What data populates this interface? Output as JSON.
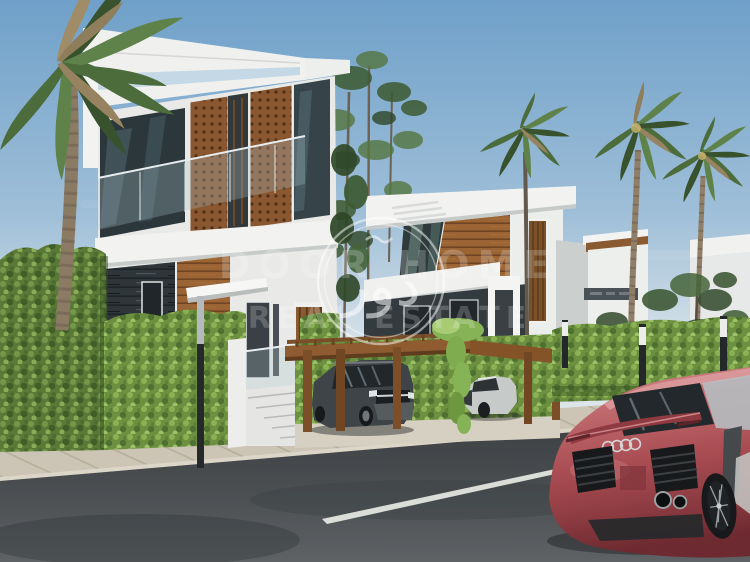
{
  "image": {
    "type": "3d-architectural-rendering",
    "subject": "Street view of modern white two-storey villas with wood mashrabiya panels, carport pergola with two SUVs, palm trees, hedges and a red Audi R8 coupe on the road",
    "width": 750,
    "height": 562
  },
  "watermark": {
    "logo_arabic": "دور",
    "line1": "DOOR HOME",
    "line2": "REAL ESTATE"
  },
  "scene": {
    "objects": [
      "sky",
      "left-villa",
      "middle-villa",
      "right-building",
      "signboard",
      "left-palm-tree",
      "mid-palm-tree",
      "right-palm-trees",
      "eucalyptus-trees",
      "ivy-wall",
      "front-hedge",
      "carport-pergola",
      "hanging-vine",
      "dark-suv",
      "silver-suv",
      "red-sports-car",
      "audi-rings-badge",
      "entrance-stairs",
      "street-lamp-post",
      "light-bollards",
      "paved-sidewalk",
      "asphalt-road",
      "lane-marking",
      "watermark-logo"
    ]
  },
  "palette": {
    "sky_top": "#6FA0C9",
    "sky_horizon": "#D9E3E9",
    "villa_white": "#F2F3F1",
    "wood_cladding": "#9A6434",
    "slate_stone": "#2F363A",
    "glass_dark": "#2C373C",
    "hedge_green": "#6D9040",
    "ivy_green": "#5A7836",
    "palm_green": "#4C6C3C",
    "road_gray": "#43474A",
    "sidewalk_beige": "#CCC5B5",
    "car_red": "#A94D53",
    "watermark_white": "#FFFFFF"
  }
}
